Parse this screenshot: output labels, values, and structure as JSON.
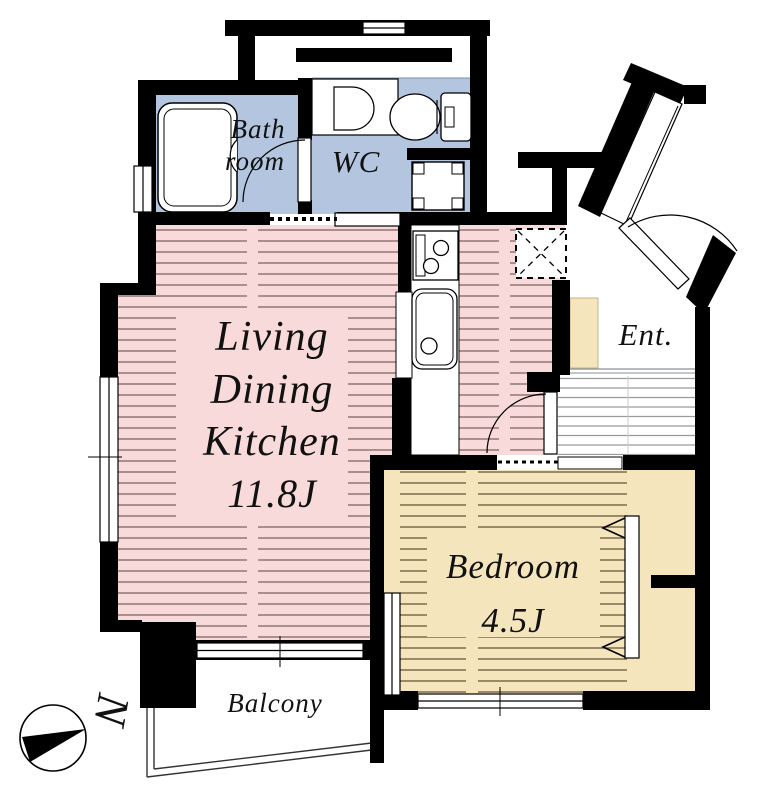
{
  "rooms": {
    "ldk": {
      "line1": "Living",
      "line2": "Dining",
      "line3": "Kitchen",
      "size": "11.8J"
    },
    "bedroom": {
      "name": "Bedroom",
      "size": "4.5J"
    },
    "bathroom": {
      "line1": "Bath",
      "line2": "room"
    },
    "wc": {
      "name": "WC"
    },
    "entrance": {
      "name": "Ent."
    },
    "balcony": {
      "name": "Balcony"
    }
  },
  "compass": {
    "letter": "N"
  },
  "colors": {
    "wall": "#000000",
    "ldk_floor": "#f9dada",
    "ldk_stripe": "#8f7676",
    "bedroom_floor": "#f4e5bd",
    "bedroom_stripe": "#7c6c4c",
    "wet_area_floor": "#b3c5df",
    "hall_stripe": "#9b9b9b",
    "background": "#ffffff"
  }
}
